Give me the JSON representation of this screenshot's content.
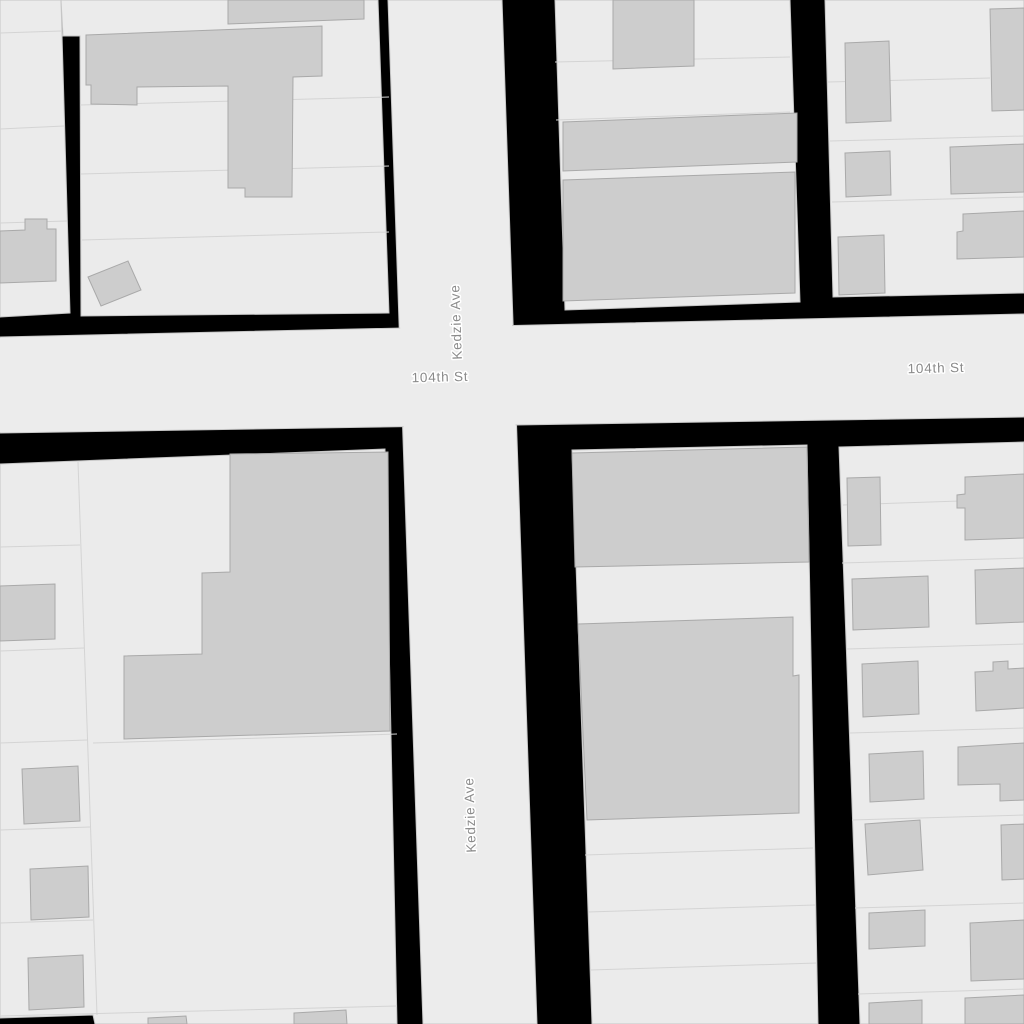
{
  "map": {
    "kind": "street-map-tile",
    "streets": [
      {
        "name": "Kedzie Ave",
        "orientation": "vertical"
      },
      {
        "name": "104th St",
        "orientation": "horizontal"
      }
    ],
    "labels": [
      {
        "text": "Kedzie Ave",
        "orientation": "vertical",
        "position": "upper"
      },
      {
        "text": "Kedzie Ave",
        "orientation": "vertical",
        "position": "lower"
      },
      {
        "text": "104th St",
        "orientation": "horizontal",
        "position": "left"
      },
      {
        "text": "104th St",
        "orientation": "horizontal",
        "position": "right"
      }
    ],
    "colors": {
      "background": "#000000",
      "parcel": "#ebebeb",
      "road": "#ececec",
      "building": "#cdcdcd",
      "building-stroke": "#a9a9a9",
      "parcel-line": "#d4d4d4",
      "block-stroke": "#c6c6c6",
      "road-stroke": "#c9c9c9",
      "label": "#8a8a8a",
      "label-halo": "#ffffff"
    }
  }
}
